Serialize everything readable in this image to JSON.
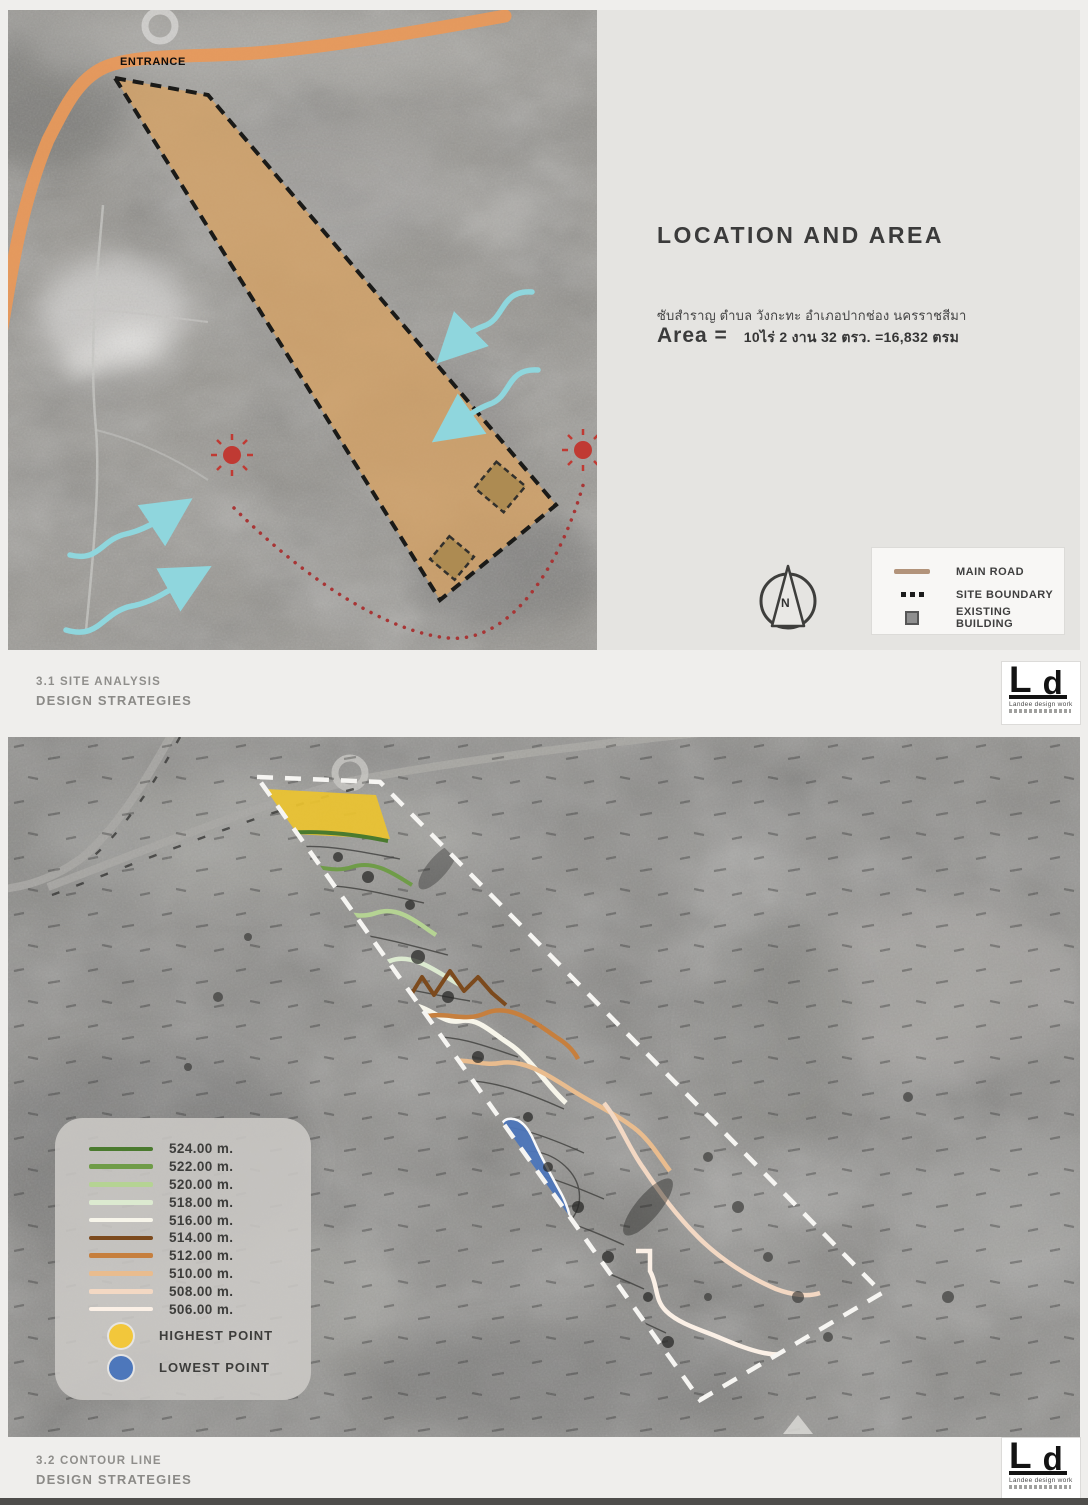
{
  "top": {
    "entrance": "ENTRANCE",
    "title": "LOCATION AND AREA",
    "address": "ซับสำราญ ตำบล วังกะทะ อำเภอปากช่อง นครราชสีมา",
    "area_label": "Area =",
    "area_value": "10ไร่ 2 งาน 32 ตรว. =16,832 ตรม",
    "north": "N",
    "legend": {
      "road": {
        "label": "MAIN ROAD",
        "color": "#b2937a"
      },
      "boundary": {
        "label": "SITE BOUNDARY",
        "color": "#1c1c1c"
      },
      "building": {
        "label": "EXISTING BUILDING",
        "color": "#8f8f8f"
      }
    },
    "colors": {
      "main_road": "#e8995b",
      "site_fill": "#d4a266",
      "sun": "#c03a33",
      "sun_path": "#a83535",
      "wind": "#8fd6dd"
    }
  },
  "footer1": {
    "section": "3.1  SITE ANALYSIS",
    "subtitle": "DESIGN STRATEGIES"
  },
  "footer2": {
    "section": "3.2  CONTOUR LINE",
    "subtitle": "DESIGN STRATEGIES"
  },
  "logo": {
    "mark_l": "L",
    "mark_d": "d",
    "tagline": "Landee design work"
  },
  "contour": {
    "levels": [
      {
        "label": "524.00 m.",
        "color": "#4a7a2e"
      },
      {
        "label": "522.00 m.",
        "color": "#6f9c48"
      },
      {
        "label": "520.00 m.",
        "color": "#b5d393"
      },
      {
        "label": "518.00 m.",
        "color": "#dcead0"
      },
      {
        "label": "516.00 m.",
        "color": "#f7f5ea"
      },
      {
        "label": "514.00 m.",
        "color": "#7c4a1d"
      },
      {
        "label": "512.00 m.",
        "color": "#c67f3e"
      },
      {
        "label": "510.00 m.",
        "color": "#e9bc8e"
      },
      {
        "label": "508.00 m.",
        "color": "#f3d8c3"
      },
      {
        "label": "506.00 m.",
        "color": "#fbf0e6"
      }
    ],
    "points": [
      {
        "label": "HIGHEST POINT",
        "color": "#f2c73b"
      },
      {
        "label": "LOWEST POINT",
        "color": "#4d77bb"
      }
    ]
  }
}
